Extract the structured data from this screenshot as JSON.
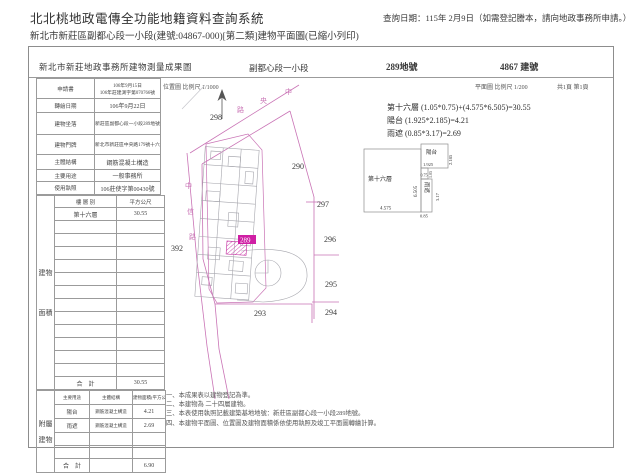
{
  "header": {
    "app_title": "北北桃地政電傳全功能地籍資料查詢系統",
    "query_date": "查詢日期：115年 2月9日（如需登記謄本，請向地政事務所申請。）",
    "doc_line": "新北市新莊區副都心段一小段(建號:04867-000)[第二類]建物平面圖(已縮小列印)"
  },
  "sheet": {
    "title": "新北市新莊地政事務所建物測量成果圖",
    "section": "副都心段一小段",
    "land_no": "289地號",
    "building_no": "4867 建號",
    "location_scale": "位置圖 比例尺 1/1000",
    "plan_scale": "平面圖 比例尺 1/200",
    "page_info": "共1頁 第1頁"
  },
  "info_table": {
    "rows": [
      {
        "label": "申請書",
        "value": "106年9月15日",
        "value2": "106年莊建測字第070766號"
      },
      {
        "label": "轉繪日期",
        "value": "106年9月22日",
        "value2": ""
      },
      {
        "label": "建物坐落",
        "value": "新莊區副都心段一小段289地號",
        "value2": ""
      },
      {
        "label": "建物門牌",
        "value": "新北市新莊區中央路179號十六樓之7",
        "value2": ""
      },
      {
        "label": "主體結構",
        "value": "鋼筋混凝土構造",
        "value2": ""
      },
      {
        "label": "主要用途",
        "value": "一般事務所",
        "value2": ""
      },
      {
        "label": "使用執照",
        "value": "106莊使字第00430號",
        "value2": ""
      }
    ]
  },
  "floor_table": {
    "side_label": "建物面積",
    "header_floor": "樓 層 別",
    "header_area": "平方公尺",
    "floor": "第十六層",
    "area": "30.55",
    "total_label": "合　計",
    "total": "30.55"
  },
  "annex_table": {
    "side_label": "附屬建物",
    "header_use": "主要用途",
    "header_structure": "主體結構",
    "header_area": "建物面積(平方公尺)",
    "rows": [
      {
        "use": "陽台",
        "structure": "鋼筋混凝土構造",
        "area": "4.21"
      },
      {
        "use": "雨遮",
        "structure": "鋼筋混凝土構造",
        "area": "2.69"
      }
    ],
    "total_label": "合　計",
    "total": "6.90"
  },
  "formulas": {
    "line1": "第十六層 (1.05*0.75)+(4.575*6.505)=30.55",
    "line2": "陽台 (1.925*2.185)=4.21",
    "line3": "雨遮 (0.85*3.17)=2.69"
  },
  "site_plan": {
    "highlight": "289",
    "parcels": {
      "p298": "298",
      "p290": "290",
      "p297": "297",
      "p296": "296",
      "p295": "295",
      "p294": "294",
      "p293": "293",
      "p392": "392"
    },
    "road_top": {
      "c1": "中",
      "c2": "央",
      "c3": "路"
    },
    "road_left": {
      "c1": "中",
      "c2": "信",
      "c3": "路"
    }
  },
  "detail": {
    "floor_label": "第十六層",
    "balcony": "陽台",
    "canopy": "雨遮",
    "dim_main_w": "4.575",
    "dim_main_h": "6.505",
    "dim_balcony_w": "1.925",
    "dim_balcony_h": "2.185",
    "dim_notch_w": "1.05",
    "dim_notch_h": "0.75",
    "dim_canopy_w": "0.85",
    "dim_canopy_h": "3.17"
  },
  "notes": {
    "n1": "一、本成果表以建物登記為準。",
    "n2": "二、本建物為 二十四層建物。",
    "n3": "三、本表使用執照記載建築基地地號：新莊區副都心段一小段289地號。",
    "n4": "四、本建物平面圖、位置圖及建物面積係依使用執照及竣工平面圖轉繪計算。"
  }
}
